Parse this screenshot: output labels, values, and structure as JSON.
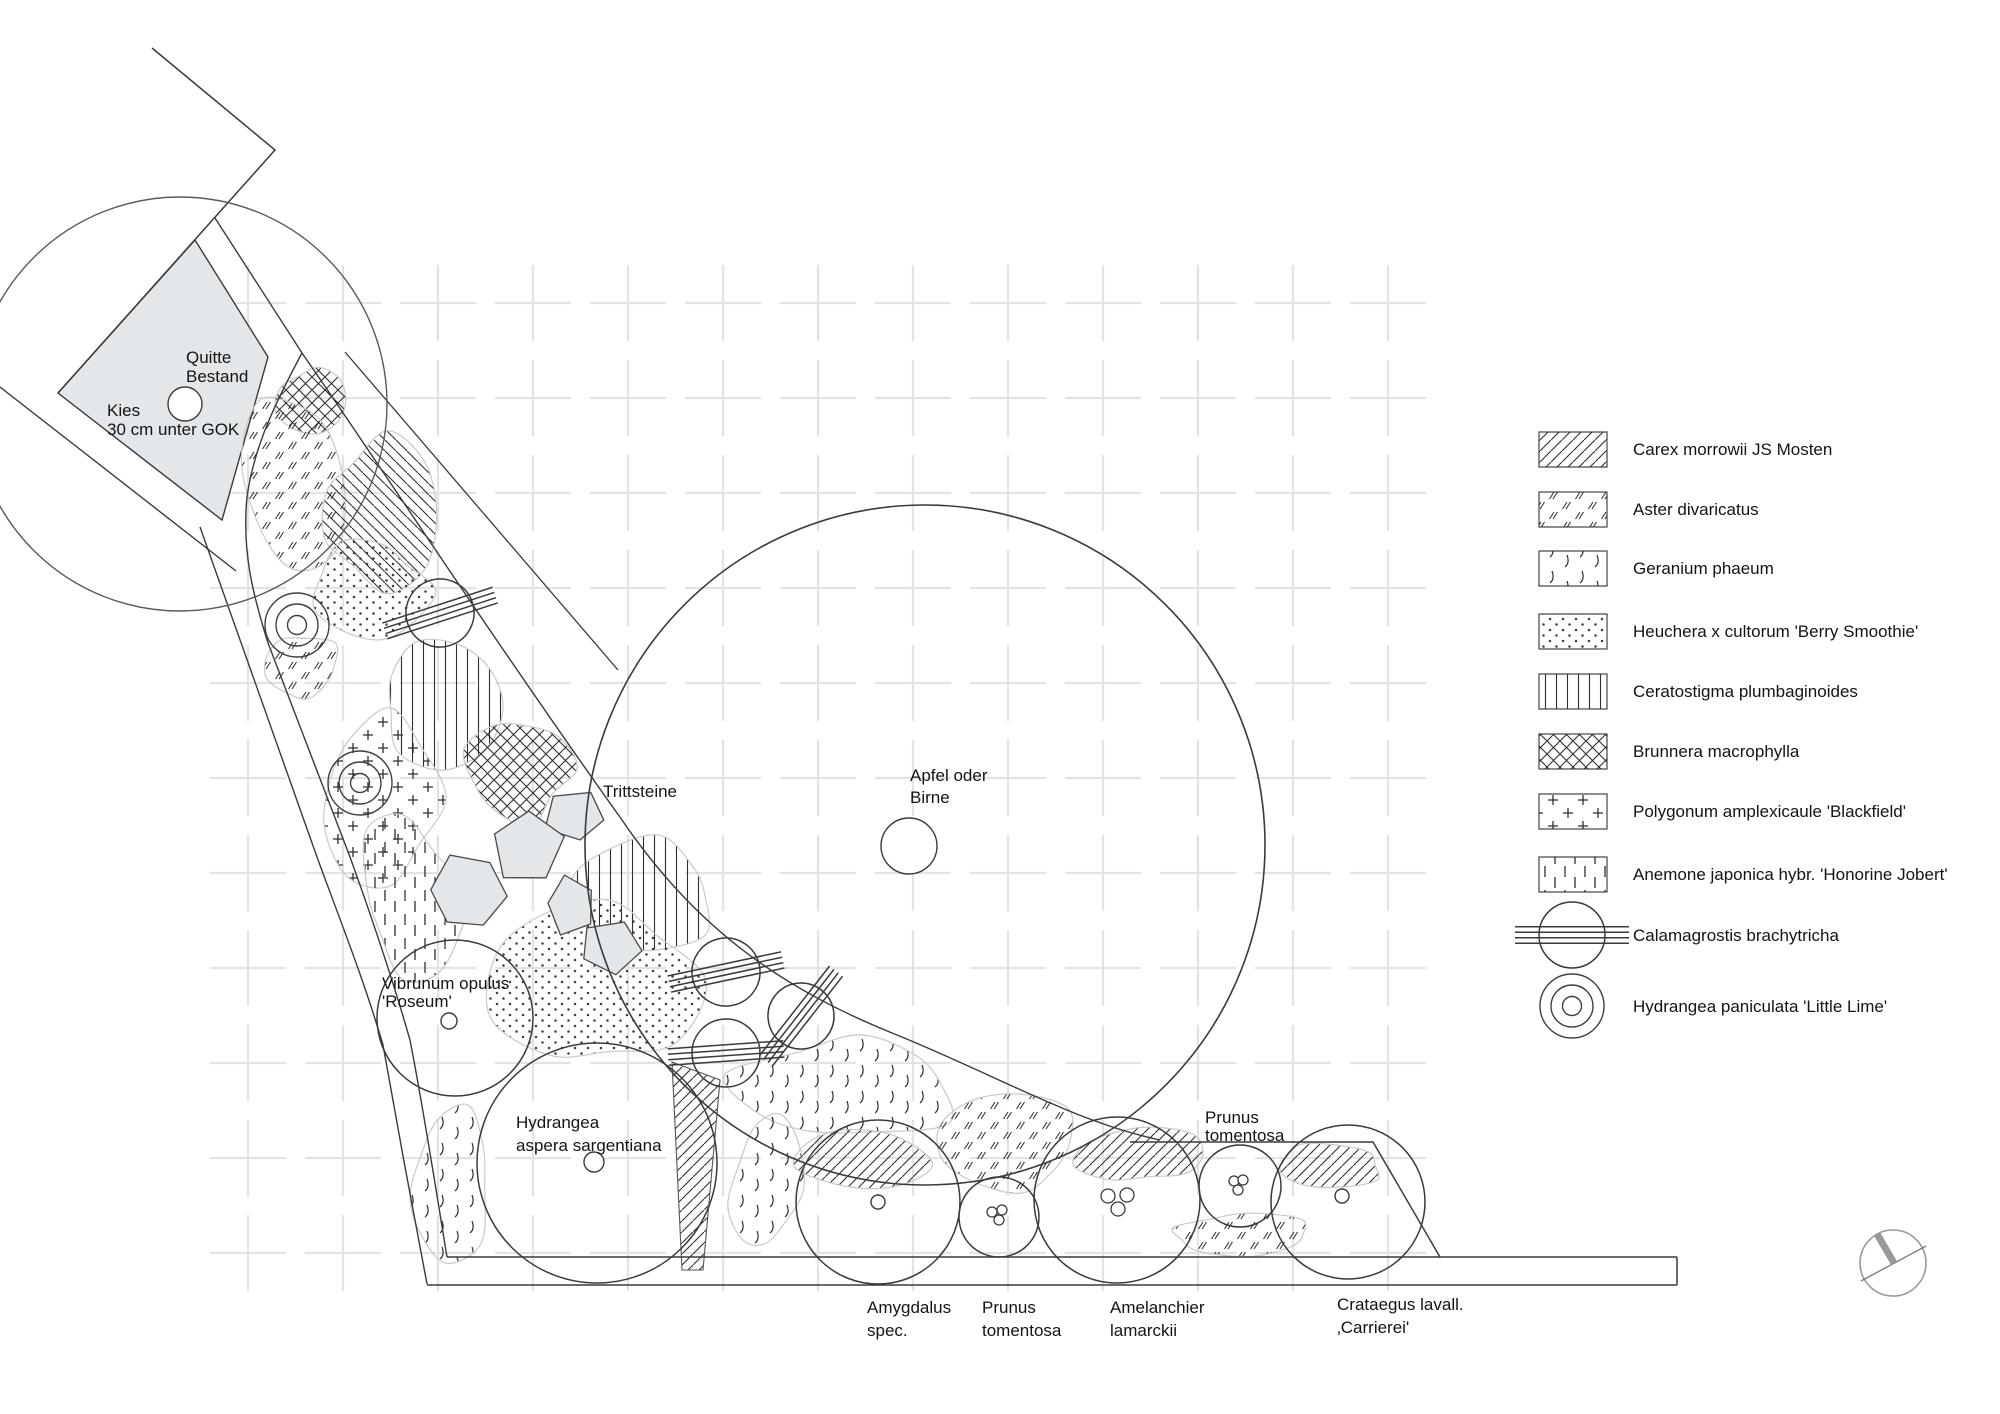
{
  "colors": {
    "paper": "#ffffff",
    "line": "#3a3a3a",
    "soft_line": "#6a6a6a",
    "patch_outline": "#c9c9c9",
    "stone_fill": "#e3e7ea",
    "stone_stroke": "#4a4a4a",
    "grid": "#e3e3e3",
    "north_gray": "#999999",
    "text": "#141414"
  },
  "plan": {
    "labels": [
      {
        "id": "quitte",
        "lines": [
          "Quitte",
          "Bestand"
        ],
        "x": 186,
        "y": [
          363,
          382
        ]
      },
      {
        "id": "kies",
        "lines": [
          "Kies",
          "30 cm unter GOK"
        ],
        "x": 107,
        "y": [
          416,
          435
        ]
      },
      {
        "id": "trittsteine",
        "lines": [
          "Trittsteine"
        ],
        "x": 603,
        "y": [
          797
        ]
      },
      {
        "id": "apfel",
        "lines": [
          "Apfel oder",
          "Birne"
        ],
        "x": 910,
        "y": [
          781,
          803
        ]
      },
      {
        "id": "vibrunum",
        "lines": [
          "Vibrunum opulus",
          "'Roseum'"
        ],
        "x": 382,
        "y": [
          989,
          1007
        ]
      },
      {
        "id": "hydrangea-aspera",
        "lines": [
          "Hydrangea",
          "aspera sargentiana"
        ],
        "x": 516,
        "y": [
          1128,
          1151
        ]
      },
      {
        "id": "amygdalus",
        "lines": [
          "Amygdalus",
          "spec."
        ],
        "x": 867,
        "y": [
          1313,
          1336
        ]
      },
      {
        "id": "prunus-bottom",
        "lines": [
          "Prunus",
          "tomentosa"
        ],
        "x": 982,
        "y": [
          1313,
          1336
        ]
      },
      {
        "id": "amelanchier",
        "lines": [
          "Amelanchier",
          "lamarckii"
        ],
        "x": 1110,
        "y": [
          1313,
          1336
        ]
      },
      {
        "id": "prunus-upper",
        "lines": [
          "Prunus",
          "tomentosa"
        ],
        "x": 1205,
        "y": [
          1123,
          1141
        ]
      },
      {
        "id": "crataegus",
        "lines": [
          "Crataegus lavall.",
          "‚Carrierei'"
        ],
        "x": 1337,
        "y": [
          1310,
          1333
        ]
      }
    ],
    "patches": [
      {
        "plant": "brunnera",
        "cx": 312,
        "cy": 400,
        "rx": 34,
        "ry": 33,
        "rot": 0,
        "seed": 11
      },
      {
        "plant": "aster",
        "cx": 298,
        "cy": 488,
        "rx": 48,
        "ry": 92,
        "rot": -8,
        "seed": 21
      },
      {
        "plant": "carex2",
        "cx": 376,
        "cy": 515,
        "rx": 57,
        "ry": 73,
        "rot": 0,
        "seed": 31
      },
      {
        "plant": "heuchera",
        "cx": 373,
        "cy": 590,
        "rx": 55,
        "ry": 48,
        "rot": 0,
        "seed": 41
      },
      {
        "plant": "aster",
        "cx": 300,
        "cy": 668,
        "rx": 40,
        "ry": 33,
        "rot": 0,
        "seed": 51
      },
      {
        "plant": "ceratostigma",
        "cx": 440,
        "cy": 700,
        "rx": 63,
        "ry": 61,
        "rot": 8,
        "seed": 61
      },
      {
        "plant": "polygonum",
        "cx": 380,
        "cy": 798,
        "rx": 60,
        "ry": 86,
        "rot": 0,
        "seed": 71
      },
      {
        "plant": "anemone",
        "cx": 412,
        "cy": 905,
        "rx": 50,
        "ry": 80,
        "rot": -12,
        "seed": 81
      },
      {
        "plant": "brunnera",
        "cx": 520,
        "cy": 768,
        "rx": 54,
        "ry": 50,
        "rot": 0,
        "seed": 91
      },
      {
        "plant": "ceratostigma",
        "cx": 645,
        "cy": 897,
        "rx": 72,
        "ry": 53,
        "rot": 0,
        "seed": 101
      },
      {
        "plant": "heuchera",
        "cx": 595,
        "cy": 982,
        "rx": 93,
        "ry": 86,
        "rot": 0,
        "seed": 111
      },
      {
        "plant": "geranium",
        "cx": 450,
        "cy": 1180,
        "rx": 44,
        "ry": 76,
        "rot": 8,
        "seed": 121
      },
      {
        "plant": "geranium",
        "cx": 845,
        "cy": 1088,
        "rx": 110,
        "ry": 56,
        "rot": -4,
        "seed": 131
      },
      {
        "plant": "geranium",
        "cx": 766,
        "cy": 1185,
        "rx": 34,
        "ry": 66,
        "rot": 6,
        "seed": 141
      },
      {
        "plant": "carex",
        "cx": 870,
        "cy": 1160,
        "rx": 70,
        "ry": 32,
        "rot": 4,
        "seed": 151
      },
      {
        "plant": "aster",
        "cx": 1010,
        "cy": 1143,
        "rx": 66,
        "ry": 46,
        "rot": 0,
        "seed": 161
      },
      {
        "plant": "carex",
        "cx": 1140,
        "cy": 1155,
        "rx": 60,
        "ry": 28,
        "rot": 0,
        "seed": 171
      },
      {
        "plant": "aster",
        "cx": 1235,
        "cy": 1234,
        "rx": 72,
        "ry": 20,
        "rot": 0,
        "seed": 181
      },
      {
        "plant": "carex",
        "cx": 1332,
        "cy": 1165,
        "rx": 54,
        "ry": 22,
        "rot": 0,
        "seed": 191
      }
    ],
    "carex_wedge": "M672,1062 L720,1080 L703,1270 L682,1270 Z",
    "trees": [
      {
        "id": "quitte-crown",
        "cx": 180,
        "cy": 404,
        "r": 207,
        "stroke": "#5a5a5a",
        "w": 1.4
      },
      {
        "id": "apfel-crown",
        "cx": 925,
        "cy": 845,
        "r": 340,
        "stroke": "#3a3a3a",
        "w": 1.6
      },
      {
        "id": "vibrunum-crown",
        "cx": 455,
        "cy": 1018,
        "r": 78,
        "stroke": "#3a3a3a",
        "w": 1.5
      },
      {
        "id": "hydrangea-aspera-crown",
        "cx": 597,
        "cy": 1163,
        "r": 120,
        "stroke": "#3a3a3a",
        "w": 1.5
      },
      {
        "id": "amygdalus-crown",
        "cx": 878,
        "cy": 1202,
        "r": 82,
        "stroke": "#3a3a3a",
        "w": 1.5
      },
      {
        "id": "prunus-bottom-crown",
        "cx": 999,
        "cy": 1217,
        "r": 40,
        "stroke": "#3a3a3a",
        "w": 1.5
      },
      {
        "id": "amelanchier-crown",
        "cx": 1117,
        "cy": 1200,
        "r": 83,
        "stroke": "#3a3a3a",
        "w": 1.5
      },
      {
        "id": "prunus-upper-crown",
        "cx": 1240,
        "cy": 1186,
        "r": 41,
        "stroke": "#3a3a3a",
        "w": 1.5
      },
      {
        "id": "crataegus-crown",
        "cx": 1348,
        "cy": 1202,
        "r": 77,
        "stroke": "#3a3a3a",
        "w": 1.5
      }
    ],
    "trunks": [
      {
        "id": "quitte-trunk",
        "cx": 185,
        "cy": 404,
        "r": 17
      },
      {
        "id": "apfel-trunk",
        "cx": 909,
        "cy": 846,
        "r": 28
      },
      {
        "id": "vibrunum-trunk",
        "cx": 449,
        "cy": 1021,
        "r": 8
      },
      {
        "id": "hydrangea-aspera-trunk",
        "cx": 594,
        "cy": 1162,
        "r": 10
      },
      {
        "id": "amygdalus-trunk",
        "cx": 878,
        "cy": 1202,
        "r": 7
      },
      {
        "id": "crataegus-trunk",
        "cx": 1342,
        "cy": 1196,
        "r": 7
      }
    ],
    "stem_groups": [
      {
        "id": "prunus-bottom-stems",
        "circles": [
          [
            992,
            1212,
            5
          ],
          [
            1002,
            1210,
            5
          ],
          [
            999,
            1220,
            5
          ]
        ]
      },
      {
        "id": "amelanchier-stems",
        "circles": [
          [
            1108,
            1196,
            7
          ],
          [
            1127,
            1195,
            7
          ],
          [
            1118,
            1209,
            7
          ]
        ]
      },
      {
        "id": "prunus-upper-stems",
        "circles": [
          [
            1234,
            1181,
            5
          ],
          [
            1243,
            1180,
            5
          ],
          [
            1238,
            1190,
            5
          ]
        ]
      }
    ],
    "grass_symbols": [
      {
        "cx": 440,
        "cy": 613,
        "r": 34,
        "angle": -18
      },
      {
        "cx": 726,
        "cy": 972,
        "r": 34,
        "angle": -12
      },
      {
        "cx": 726,
        "cy": 1053,
        "r": 34,
        "angle": -4
      },
      {
        "cx": 801,
        "cy": 1016,
        "r": 33,
        "angle": -52
      }
    ],
    "ring_symbols": [
      {
        "cx": 297,
        "cy": 625
      },
      {
        "cx": 360,
        "cy": 783
      }
    ],
    "stones": [
      {
        "cx": 576,
        "cy": 816,
        "rx": 32,
        "ry": 27,
        "sides": 5,
        "rot": 10,
        "seed": 7
      },
      {
        "cx": 527,
        "cy": 847,
        "rx": 38,
        "ry": 40,
        "sides": 5,
        "rot": -15,
        "seed": 17
      },
      {
        "cx": 468,
        "cy": 893,
        "rx": 41,
        "ry": 40,
        "sides": 6,
        "rot": 5,
        "seed": 27
      },
      {
        "cx": 571,
        "cy": 905,
        "rx": 26,
        "ry": 30,
        "sides": 5,
        "rot": 40,
        "seed": 37
      },
      {
        "cx": 610,
        "cy": 947,
        "rx": 33,
        "ry": 28,
        "sides": 5,
        "rot": 80,
        "seed": 47
      }
    ],
    "kies_polygon": "M195,240 L268,357 L222,520 L58,393 Z",
    "outlines": [
      {
        "id": "boundary-v",
        "d": "M152,48 L275,150 L58,393",
        "w": 1.5
      },
      {
        "id": "path-inner-edge",
        "d": "M215,218 L302,353",
        "w": 1.4
      },
      {
        "id": "bed-left-edge",
        "d": "M302,353 C278,398 254,445 247,497 C242,550 252,592 268,643 L350,857 C372,918 392,977 410,1040 C424,1112 436,1190 447,1257",
        "w": 1.4
      },
      {
        "id": "band-outer-edge",
        "d": "M200,527 L317,857 C340,920 364,980 383,1045 C396,1118 413,1212 427,1284",
        "w": 1.4
      },
      {
        "id": "bed-sweep-edge",
        "d": "M302,353 C380,465 490,635 622,820 C700,935 790,992 897,1035 C1000,1077 1075,1122 1160,1140",
        "w": 1.4
      },
      {
        "id": "bed-top-edge-right",
        "d": "M1130,1142 L1373,1142 L1440,1257",
        "w": 1.5
      },
      {
        "id": "inner-diagonal",
        "d": "M345,352 L618,670",
        "w": 1.3
      },
      {
        "id": "path-left-lower",
        "d": "M0,387 L236,571",
        "w": 1.4
      },
      {
        "id": "strip-top",
        "d": "M447,1257 L1677,1257",
        "w": 1.5
      },
      {
        "id": "strip-bottom",
        "d": "M427,1285 L1677,1285",
        "w": 1.5
      },
      {
        "id": "strip-right-cap",
        "d": "M1677,1257 L1677,1285",
        "w": 1.5
      }
    ],
    "grid": {
      "x0": 248,
      "y0": 303,
      "step": 95,
      "nx": 13,
      "ny": 11,
      "arm": 38
    },
    "north_symbol": {
      "cx": 1893,
      "cy": 1263,
      "r": 33,
      "line": [
        1861,
        1281,
        1926,
        1246
      ],
      "bar": [
        1877,
        1234,
        1894,
        1263
      ]
    }
  },
  "legend": {
    "swatch_x": 1539,
    "swatch_w": 68,
    "swatch_h": 35,
    "text_x": 1633,
    "items": [
      {
        "label": "Carex morrowii JS Mosten",
        "pattern": "carex",
        "y": 432
      },
      {
        "label": "Aster divaricatus",
        "pattern": "aster",
        "y": 492
      },
      {
        "label": "Geranium phaeum",
        "pattern": "geranium",
        "y": 551
      },
      {
        "label": "Heuchera x cultorum 'Berry Smoothie'",
        "pattern": "heuchera",
        "y": 614
      },
      {
        "label": "Ceratostigma plumbaginoides",
        "pattern": "ceratostigma",
        "y": 674
      },
      {
        "label": "Brunnera macrophylla",
        "pattern": "brunnera",
        "y": 734
      },
      {
        "label": "Polygonum amplexicaule 'Blackfield'",
        "pattern": "polygonum",
        "y": 794
      },
      {
        "label": "Anemone japonica hybr. 'Honorine Jobert'",
        "pattern": "anemone",
        "y": 857
      },
      {
        "label": "Calamagrostis brachytricha",
        "symbol": "grass-circle",
        "y": 903
      },
      {
        "label": "Hydrangea paniculata 'Little Lime'",
        "symbol": "ring-circle",
        "y": 974
      }
    ]
  }
}
